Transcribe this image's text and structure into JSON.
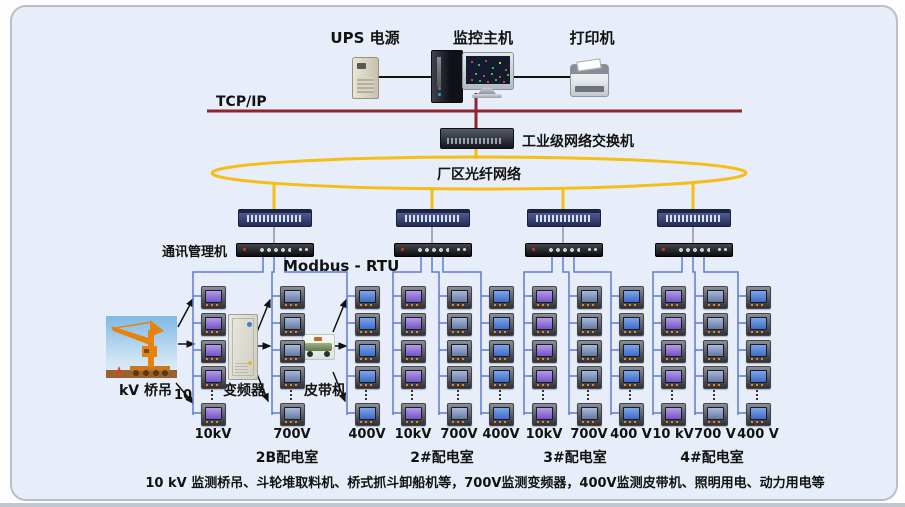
{
  "top": {
    "ups_label": "UPS 电源",
    "host_label": "监控主机",
    "printer_label": "打印机"
  },
  "network": {
    "tcpip": "TCP/IP",
    "industrial_switch": "工业级网络交换机",
    "fiber_ring": "厂区光纤网络",
    "comm_manager": "通讯管理机",
    "protocol": "Modbus - RTU"
  },
  "field": {
    "crane_prefix": "10",
    "crane": "kV 桥吊",
    "converter": "变频器",
    "belt": "皮带机"
  },
  "sections": [
    {
      "name": "2B配电室",
      "columns": [
        {
          "voltage": "10kV"
        },
        {
          "voltage": "700V"
        },
        {
          "voltage": "400V"
        }
      ]
    },
    {
      "name": "2#配电室",
      "columns": [
        {
          "voltage": "10kV"
        },
        {
          "voltage": "700V"
        },
        {
          "voltage": "400V"
        }
      ]
    },
    {
      "name": "3#配电室",
      "columns": [
        {
          "voltage": "10kV"
        },
        {
          "voltage": "700V"
        },
        {
          "voltage": "400 V"
        }
      ]
    },
    {
      "name": "4#配电室",
      "columns": [
        {
          "voltage": "10 kV"
        },
        {
          "voltage": "700 V"
        },
        {
          "voltage": "400 V"
        }
      ]
    }
  ],
  "caption": "10 kV 监测桥吊、斗轮堆取料机、桥式抓斗卸船机等，700V监测变频器，400V监测皮带机、照明用电、动力用电等",
  "colors": {
    "backbone_red": "#8e2630",
    "fiber_yellow": "#f6bd16",
    "wire_blue": "#5b7bd0",
    "board_bg": "#e7eef9"
  }
}
